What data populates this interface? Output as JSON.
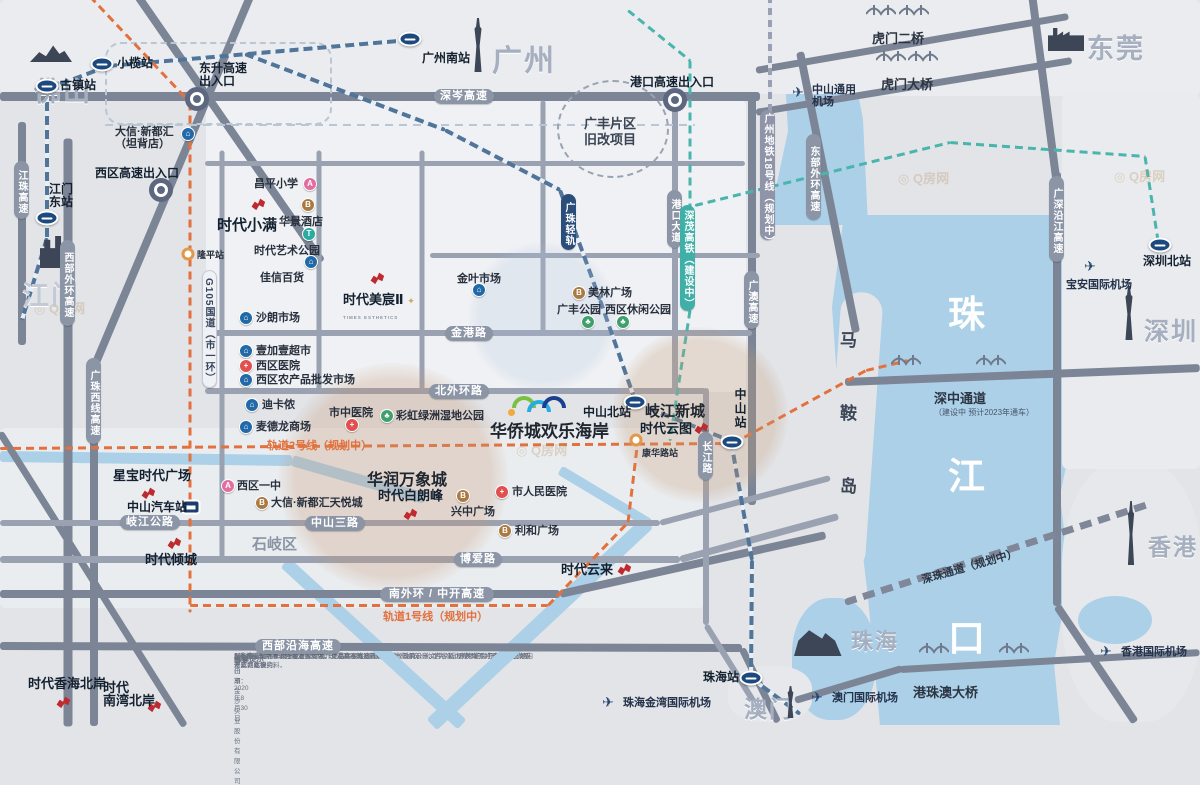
{
  "meta": {
    "width": 1200,
    "height": 720
  },
  "project_box": {
    "title": "时代美宸",
    "subtitle": "TIMES ESTHETICS"
  },
  "colors": {
    "gold": "#c9a95e",
    "times_red": "#bf2a2f",
    "plan_orange": "#e2713d",
    "rail_navy": "#2a4d79",
    "hsr_teal": "#3fb0a8",
    "water": "#abd0e8"
  },
  "watermark": {
    "text": "Q房网",
    "positions": [
      [
        34,
        298
      ],
      [
        516,
        440
      ],
      [
        898,
        168
      ],
      [
        1114,
        166
      ]
    ]
  },
  "compass": {
    "n": "N",
    "e": "E",
    "s": "S",
    "w": "W"
  },
  "cities": [
    {
      "t": "佛山",
      "x": 34,
      "y": 70,
      "fs": 27
    },
    {
      "t": "广州",
      "x": 492,
      "y": 36,
      "fs": 30
    },
    {
      "t": "东莞",
      "x": 1087,
      "y": 27,
      "fs": 27
    },
    {
      "t": "江门",
      "x": 22,
      "y": 274,
      "fs": 27,
      "light": 1
    },
    {
      "t": "深圳",
      "x": 1144,
      "y": 312,
      "fs": 25
    },
    {
      "t": "珠海",
      "x": 851,
      "y": 624,
      "fs": 22
    },
    {
      "t": "澳门",
      "x": 744,
      "y": 690,
      "fs": 23
    },
    {
      "t": "香港",
      "x": 1148,
      "y": 528,
      "fs": 23
    }
  ],
  "city_icons": [
    {
      "k": "mountain",
      "x": 30,
      "y": 44,
      "w": 42,
      "h": 18
    },
    {
      "k": "tower",
      "x": 470,
      "y": 18,
      "w": 16,
      "h": 54
    },
    {
      "k": "factory",
      "x": 1048,
      "y": 24,
      "w": 36,
      "h": 27
    },
    {
      "k": "bldg",
      "x": 40,
      "y": 236,
      "w": 27,
      "h": 32
    },
    {
      "k": "tower",
      "x": 1121,
      "y": 286,
      "w": 16,
      "h": 54
    },
    {
      "k": "opera",
      "x": 794,
      "y": 628,
      "w": 54,
      "h": 28
    },
    {
      "k": "tower",
      "x": 784,
      "y": 686,
      "w": 13,
      "h": 32
    },
    {
      "k": "tower",
      "x": 1124,
      "y": 501,
      "w": 14,
      "h": 64
    }
  ],
  "stations": [
    {
      "t": "古镇站",
      "x": 47,
      "y": 86,
      "lx": 60,
      "ly": 79
    },
    {
      "t": "小榄站",
      "x": 102,
      "y": 64,
      "lx": 117,
      "ly": 57
    },
    {
      "t": "广州南站",
      "x": 410,
      "y": 39,
      "lx": 422,
      "ly": 52
    },
    {
      "t": "江门东站",
      "x": 47,
      "y": 218,
      "lx": 49,
      "ly": 183,
      "lines": [
        "江门",
        "东站"
      ]
    },
    {
      "t": "中山北站",
      "x": 635,
      "y": 402,
      "lx": 583,
      "ly": 406
    },
    {
      "t": "中山站",
      "x": 732,
      "y": 442,
      "lx": 733,
      "ly": 388,
      "vert": 1
    },
    {
      "t": "深圳北站",
      "x": 1160,
      "y": 245,
      "lx": 1143,
      "ly": 255
    },
    {
      "t": "珠海站",
      "x": 751,
      "y": 678,
      "lx": 703,
      "ly": 671
    }
  ],
  "bus_station": {
    "t": "中山汽车站",
    "x": 191,
    "y": 507,
    "lx": 127,
    "ly": 501
  },
  "small_stations": [
    {
      "t": "隆平站",
      "x": 188,
      "y": 254,
      "lx": 197,
      "ly": 249
    },
    {
      "t": "康华路站",
      "x": 636,
      "y": 440,
      "lx": 642,
      "ly": 447
    }
  ],
  "interchanges": [
    {
      "lines": [
        "东升高速",
        "出入口"
      ],
      "x": 197,
      "y": 99,
      "lx": 199,
      "ly": 62
    },
    {
      "lines": [
        "港口高速出入口"
      ],
      "x": 675,
      "y": 100,
      "lx": 630,
      "ly": 76
    },
    {
      "lines": [
        "西区高速出入口"
      ],
      "x": 161,
      "y": 190,
      "lx": 95,
      "ly": 167
    }
  ],
  "projects": [
    {
      "t": "时代小满",
      "lx": 217,
      "ly": 219,
      "gx": 250,
      "gy": 197,
      "fs": 15
    },
    {
      "t": "时代美宸Ⅱ",
      "lx": 343,
      "ly": 293,
      "gx": 369,
      "gy": 271,
      "fs": 13,
      "sub": "TIMES ESTHETICS",
      "spark": 1
    },
    {
      "t": "时代云图",
      "lx": 640,
      "ly": 422,
      "gx": 693,
      "gy": 421,
      "fs": 13
    },
    {
      "t": "时代白朗峰",
      "lx": 378,
      "ly": 489,
      "gx": 402,
      "gy": 507,
      "fs": 13
    },
    {
      "t": "时代云来",
      "lx": 561,
      "ly": 563,
      "gx": 616,
      "gy": 562,
      "fs": 13
    },
    {
      "t": "时代倾城",
      "lx": 145,
      "ly": 553,
      "gx": 166,
      "gy": 536,
      "fs": 13
    },
    {
      "t": "星宝时代广场",
      "lx": 113,
      "ly": 469,
      "gx": 140,
      "gy": 486,
      "fs": 13
    },
    {
      "t": "时代香海北岸",
      "lx": 28,
      "ly": 677,
      "gx": 55,
      "gy": 695,
      "fs": 13
    },
    {
      "t": "时代南湾北岸",
      "lines": [
        "时代",
        "南湾北岸"
      ],
      "lx": 103,
      "ly": 681,
      "gx": 146,
      "gy": 699,
      "fs": 13
    }
  ],
  "pois": [
    {
      "k": "school",
      "x": 310,
      "y": 184,
      "lx": 254,
      "ly": 178,
      "t": "昌平小学"
    },
    {
      "k": "hotel",
      "x": 308,
      "y": 205,
      "lx": 279,
      "ly": 216,
      "t": "华景酒店"
    },
    {
      "k": "metro",
      "x": 309,
      "y": 234,
      "lx": 254,
      "ly": 245,
      "t": "时代艺术公园"
    },
    {
      "k": "shop",
      "x": 311,
      "y": 262,
      "lx": 260,
      "ly": 272,
      "t": "佳信百货"
    },
    {
      "k": "shop",
      "x": 246,
      "y": 318,
      "lx": 256,
      "ly": 312,
      "t": "沙朗市场"
    },
    {
      "k": "shop",
      "x": 479,
      "y": 290,
      "lx": 457,
      "ly": 273,
      "t": "金叶市场"
    },
    {
      "k": "shop",
      "x": 246,
      "y": 351,
      "lx": 256,
      "ly": 345,
      "t": "壹加壹超市"
    },
    {
      "k": "hosp",
      "x": 246,
      "y": 366,
      "lx": 256,
      "ly": 360,
      "t": "西区医院"
    },
    {
      "k": "shop",
      "x": 246,
      "y": 380,
      "lx": 256,
      "ly": 374,
      "t": "西区农产品批发市场"
    },
    {
      "k": "shop",
      "x": 252,
      "y": 405,
      "lx": 262,
      "ly": 399,
      "t": "迪卡侬"
    },
    {
      "k": "hosp",
      "x": 352,
      "y": 425,
      "lx": 329,
      "ly": 407,
      "t": "市中医院"
    },
    {
      "k": "park",
      "x": 387,
      "y": 416,
      "lx": 396,
      "ly": 410,
      "t": "彩虹绿洲湿地公园"
    },
    {
      "k": "shop",
      "x": 246,
      "y": 427,
      "lx": 256,
      "ly": 421,
      "t": "麦德龙商场"
    },
    {
      "k": "hotel",
      "x": 579,
      "y": 293,
      "lx": 588,
      "ly": 287,
      "t": "美林广场"
    },
    {
      "k": "park",
      "x": 588,
      "y": 322,
      "lx": 557,
      "ly": 304,
      "t": "广丰公园"
    },
    {
      "k": "park",
      "x": 623,
      "y": 322,
      "lx": 605,
      "ly": 304,
      "t": "西区休闲公园"
    },
    {
      "k": "school",
      "x": 228,
      "y": 486,
      "lx": 237,
      "ly": 480,
      "t": "西区一中"
    },
    {
      "k": "hotel",
      "x": 262,
      "y": 503,
      "lx": 271,
      "ly": 497,
      "t": "大信·新都汇天悦城"
    },
    {
      "k": "hosp",
      "x": 502,
      "y": 492,
      "lx": 512,
      "ly": 486,
      "t": "市人民医院"
    },
    {
      "k": "hotel",
      "x": 463,
      "y": 496,
      "lx": 451,
      "ly": 506,
      "t": "兴中广场"
    },
    {
      "k": "hotel",
      "x": 505,
      "y": 531,
      "lx": 515,
      "ly": 525,
      "t": "利和广场"
    },
    {
      "k": "shop",
      "x": 188,
      "y": 134,
      "lx": 115,
      "ly": 126,
      "t": "大信·新都汇（坦背店）",
      "lines": [
        "大信·新都汇",
        "（坦背店）"
      ]
    }
  ],
  "bold_labels": [
    {
      "t": "华润万象城",
      "x": 367,
      "y": 466,
      "fs": 16
    },
    {
      "t": "岐江新城",
      "x": 645,
      "y": 400,
      "fs": 15
    },
    {
      "t": "华侨城欢乐海岸",
      "x": 490,
      "y": 417,
      "fs": 17
    },
    {
      "t": "石岐区",
      "x": 252,
      "y": 533,
      "fs": 15,
      "c": "#8b94a4"
    }
  ],
  "road_pills_h": [
    {
      "t": "深岑高速",
      "x": 434,
      "y": 89,
      "w": 60
    },
    {
      "t": "金港路",
      "x": 445,
      "y": 326,
      "w": 48
    },
    {
      "t": "北外环路",
      "x": 429,
      "y": 384,
      "w": 60
    },
    {
      "t": "中山三路",
      "x": 305,
      "y": 516,
      "w": 60
    },
    {
      "t": "岐江公路",
      "x": 120,
      "y": 515,
      "w": 60
    },
    {
      "t": "博爱路",
      "x": 454,
      "y": 552,
      "w": 48
    },
    {
      "t": "南外环 / 中开高速",
      "x": 380,
      "y": 587,
      "w": 114
    },
    {
      "t": "西部沿海高速",
      "x": 255,
      "y": 639,
      "w": 86
    }
  ],
  "road_pills_v": [
    {
      "t": "港口大道",
      "x": 667,
      "y": 190,
      "h": 58
    },
    {
      "t": "长江路",
      "x": 698,
      "y": 432,
      "h": 48
    },
    {
      "t": "广澳高速",
      "x": 744,
      "y": 271,
      "h": 58
    },
    {
      "t": "东部外环高速",
      "x": 806,
      "y": 134,
      "h": 86
    },
    {
      "t": "广深沿江高速",
      "x": 1049,
      "y": 176,
      "h": 86
    },
    {
      "t": "江珠高速",
      "x": 14,
      "y": 161,
      "h": 58
    },
    {
      "t": "西部外环高速",
      "x": 60,
      "y": 240,
      "h": 86
    },
    {
      "t": "广珠西线高速",
      "x": 86,
      "y": 358,
      "h": 86
    },
    {
      "t": "G105国道（市一环）",
      "x": 202,
      "y": 270,
      "h": 118,
      "light": 1
    }
  ],
  "rail_pills": [
    {
      "t": "广珠轻轨",
      "x": 561,
      "y": 194,
      "h": 56,
      "c": "#2a4d79"
    },
    {
      "t": "深茂高铁（建设中）",
      "x": 680,
      "y": 205,
      "h": 106,
      "c": "#3fb0a8"
    },
    {
      "t": "广州地铁18号线（规划中）",
      "x": 760,
      "y": 110,
      "h": 130,
      "c": "#8f94a9"
    }
  ],
  "plain_labels": [
    {
      "t": "虎门二桥",
      "x": 872,
      "y": 28,
      "fs": 13
    },
    {
      "t": "虎门大桥",
      "x": 881,
      "y": 74,
      "fs": 13
    },
    {
      "t": "港珠澳大桥",
      "x": 913,
      "y": 682,
      "fs": 13
    },
    {
      "t": "深中通道",
      "x": 934,
      "y": 388,
      "fs": 13,
      "sub": "（建设中  预计2023年通车）"
    },
    {
      "t": "深珠通道（规划中）",
      "x": 920,
      "y": 558,
      "fs": 11,
      "rot": -16
    },
    {
      "t": "轨道2号线（规划中）",
      "x": 267,
      "y": 437,
      "fs": 11,
      "c": "#e2713d"
    },
    {
      "t": "轨道1号线（规划中）",
      "x": 383,
      "y": 608,
      "fs": 11,
      "c": "#e2713d"
    }
  ],
  "vertical_texts": [
    {
      "chars": [
        "马",
        "鞍",
        "岛"
      ],
      "x": 840,
      "y": 326,
      "gap": 73,
      "fs": 17,
      "c": "#3c4656"
    },
    {
      "chars": [
        "珠",
        "江",
        "口"
      ],
      "x": 948,
      "y": 284,
      "gap": 162,
      "fs": 37,
      "c": "#ffffff"
    }
  ],
  "airports": [
    {
      "t": "中山通用机场",
      "x": 798,
      "y": 92,
      "lx": 812,
      "ly": 84,
      "lines": [
        "中山通用",
        "机场"
      ]
    },
    {
      "t": "宝安国际机场",
      "x": 1090,
      "y": 266,
      "lx": 1066,
      "ly": 279
    },
    {
      "t": "珠海金湾国际机场",
      "x": 608,
      "y": 702,
      "lx": 623,
      "ly": 697
    },
    {
      "t": "澳门国际机场",
      "x": 817,
      "y": 697,
      "lx": 832,
      "ly": 692
    },
    {
      "t": "香港国际机场",
      "x": 1106,
      "y": 651,
      "lx": 1121,
      "ly": 646
    }
  ],
  "zone": {
    "x": 557,
    "y": 80,
    "w": 112,
    "h": 98,
    "lines": [
      "广丰片区",
      "旧改项目"
    ],
    "lx": 584,
    "ly": 116
  },
  "attraction_logo": {
    "x": 512,
    "y": 396,
    "colors": [
      "#7ac143",
      "#29abe2",
      "#1b3f8f"
    ]
  },
  "bridges": [
    {
      "x": 866,
      "y": 2
    },
    {
      "x": 899,
      "y": 2
    },
    {
      "x": 876,
      "y": 48
    },
    {
      "x": 908,
      "y": 48
    },
    {
      "x": 891,
      "y": 352
    },
    {
      "x": 976,
      "y": 352
    },
    {
      "x": 919,
      "y": 640
    },
    {
      "x": 999,
      "y": 640
    }
  ],
  "disclaimer": {
    "title": "温馨提示",
    "lines": [
      "1.本模型仅对本项目周边的环境、交通及建筑设施等信息做效果示意，内容及比例可能会与实际情况存在差异，本模",
      "型所展示内容来源于截止模型制作之日本项目周边的现状、政府公示文件、新闻媒体的公开报道或工地内开发商建设资料，",
      "展示内容最终以政府批准文件及《商品房买卖合同》（含补充协议）约定为准，开发商不对展示内容做承诺或据此要约。",
      "2.若本模型所展示内容发生变化，开发商不再另行通知。"
    ],
    "company": "中山市金沙实业股份有限公司",
    "made": "制作日期：2020年8月30日"
  },
  "geometry": {
    "tints": [
      [
        0,
        0,
        1200,
        94,
        "#eaecef"
      ],
      [
        850,
        0,
        350,
        96,
        "#eaecef"
      ],
      [
        206,
        100,
        540,
        292,
        "#eff1f4"
      ],
      [
        0,
        428,
        705,
        180,
        "#eaedf0"
      ],
      [
        1062,
        94,
        138,
        375,
        "#e9ebee"
      ]
    ],
    "roads_dark": [
      [
        0,
        96,
        760,
        96,
        9
      ],
      [
        135,
        -8,
        322,
        262,
        8
      ],
      [
        252,
        -8,
        92,
        372,
        8
      ],
      [
        94,
        360,
        94,
        726,
        8
      ],
      [
        68,
        138,
        68,
        726,
        9
      ],
      [
        22,
        122,
        22,
        345,
        8
      ],
      [
        0,
        432,
        185,
        726,
        7
      ],
      [
        752,
        96,
        752,
        505,
        8
      ],
      [
        800,
        52,
        856,
        332,
        8
      ],
      [
        1032,
        -6,
        1057,
        185,
        8
      ],
      [
        1057,
        172,
        1057,
        606,
        8
      ],
      [
        1057,
        606,
        1135,
        722,
        8
      ],
      [
        845,
        382,
        1200,
        368,
        8
      ],
      [
        756,
        70,
        1068,
        16,
        7
      ],
      [
        756,
        112,
        1072,
        60,
        7
      ],
      [
        795,
        700,
        902,
        668,
        7
      ],
      [
        900,
        669,
        1200,
        652,
        7
      ],
      [
        0,
        594,
        560,
        594,
        8
      ],
      [
        560,
        594,
        826,
        535,
        8
      ],
      [
        0,
        646,
        742,
        648,
        8
      ],
      [
        742,
        648,
        778,
        722,
        7
      ]
    ],
    "roads_mid": [
      [
        205,
        163,
        745,
        163,
        5
      ],
      [
        222,
        150,
        222,
        560,
        5
      ],
      [
        319,
        150,
        319,
        392,
        5
      ],
      [
        422,
        150,
        422,
        392,
        5
      ],
      [
        543,
        100,
        543,
        335,
        5
      ],
      [
        430,
        255,
        760,
        255,
        5
      ],
      [
        675,
        96,
        675,
        391,
        6
      ],
      [
        205,
        333,
        752,
        333,
        6
      ],
      [
        205,
        391,
        706,
        391,
        6
      ],
      [
        706,
        388,
        706,
        625,
        6
      ],
      [
        706,
        625,
        762,
        715,
        6
      ],
      [
        0,
        523,
        660,
        523,
        6
      ],
      [
        660,
        523,
        830,
        478,
        6
      ],
      [
        0,
        559,
        680,
        559,
        7
      ],
      [
        680,
        559,
        838,
        516,
        7
      ]
    ],
    "rail_navy": [
      [
        410,
        40,
        108,
        66,
        4
      ],
      [
        108,
        66,
        50,
        88,
        4
      ],
      [
        47,
        88,
        47,
        238,
        4
      ],
      [
        47,
        238,
        22,
        320,
        4
      ],
      [
        245,
        54,
        445,
        130,
        4
      ],
      [
        445,
        130,
        560,
        190,
        4
      ],
      [
        560,
        190,
        600,
        300,
        4
      ],
      [
        600,
        300,
        635,
        400,
        4
      ],
      [
        635,
        403,
        731,
        441,
        4
      ],
      [
        731,
        441,
        752,
        560,
        4
      ],
      [
        752,
        560,
        751,
        678,
        4
      ],
      [
        751,
        678,
        800,
        714,
        4
      ]
    ],
    "rail_light": [
      [
        105,
        125,
        695,
        125,
        2
      ]
    ],
    "dashrects": [
      [
        105,
        42,
        227,
        83
      ]
    ],
    "rail_teal": [
      [
        628,
        10,
        690,
        60,
        3
      ],
      [
        690,
        60,
        690,
        310,
        3
      ],
      [
        690,
        310,
        670,
        440,
        3
      ],
      [
        695,
        205,
        950,
        142,
        3
      ],
      [
        950,
        142,
        1145,
        156,
        3
      ],
      [
        1145,
        156,
        1158,
        240,
        3
      ]
    ],
    "rail_orange": [
      [
        90,
        -4,
        190,
        102,
        3
      ],
      [
        190,
        102,
        190,
        612,
        3
      ],
      [
        0,
        448,
        733,
        443,
        3
      ],
      [
        733,
        443,
        866,
        370,
        3
      ],
      [
        866,
        370,
        908,
        360,
        3
      ],
      [
        190,
        605,
        548,
        605,
        3
      ],
      [
        548,
        605,
        628,
        522,
        3
      ],
      [
        628,
        522,
        637,
        447,
        3
      ]
    ],
    "rail_g18": [
      [
        770,
        -4,
        770,
        235,
        4
      ]
    ],
    "rail_sz": [
      [
        845,
        602,
        1148,
        504,
        7
      ]
    ],
    "wsegs": [
      [
        0,
        456,
        292,
        460,
        11
      ],
      [
        292,
        460,
        425,
        498,
        11
      ],
      [
        648,
        522,
        432,
        724,
        15
      ],
      [
        285,
        562,
        462,
        724,
        13
      ],
      [
        560,
        470,
        650,
        524,
        10
      ]
    ],
    "glows": [
      [
        278,
        363,
        230,
        "rgba(197,148,112,0.28)"
      ],
      [
        612,
        327,
        176,
        "rgba(197,155,118,0.28)"
      ],
      [
        468,
        242,
        150,
        "rgba(175,195,220,0.22)"
      ]
    ]
  }
}
